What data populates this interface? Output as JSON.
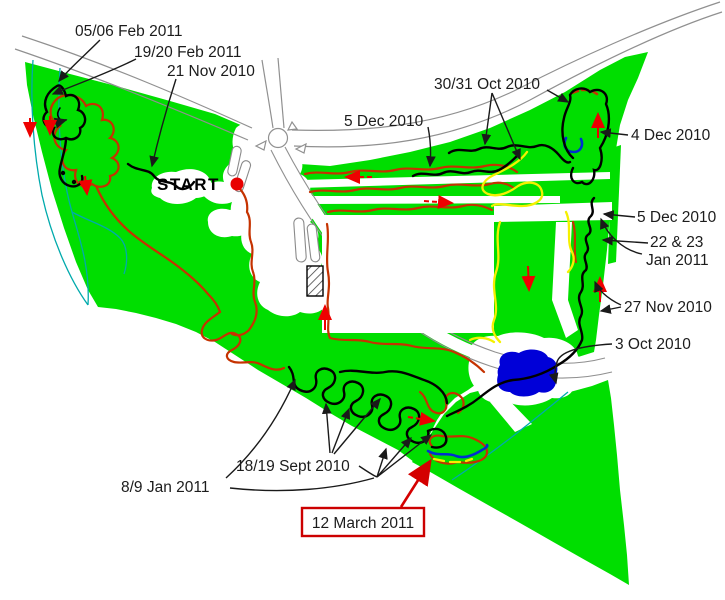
{
  "map": {
    "start_label": "START",
    "labels": {
      "feb_05_06": "05/06 Feb 2011",
      "feb_19_20": "19/20 Feb 2011",
      "nov_21": "21 Nov 2010",
      "oct_30_31": "30/31 Oct 2010",
      "dec_5_top": "5 Dec 2010",
      "dec_4": "4 Dec 2010",
      "dec_5_right": "5 Dec 2010",
      "jan_22_23_line1": "22 & 23",
      "jan_22_23_line2": "Jan 2011",
      "nov_27": "27 Nov 2010",
      "oct_3": "3 Oct 2010",
      "sept_18_19": "18/19 Sept 2010",
      "jan_8_9": "8/9 Jan 2011",
      "march_12": "12 March 2011"
    },
    "colors": {
      "woodland_green": "#00DE00",
      "trail_red": "#C53200",
      "trail_black": "#000000",
      "trail_yellow": "#F5F000",
      "trail_blue": "#0030D0",
      "stream_teal": "#00AAAC",
      "pond_blue": "#0000D8",
      "highlight_red": "#EE0000",
      "road_gray": "#909090"
    }
  }
}
